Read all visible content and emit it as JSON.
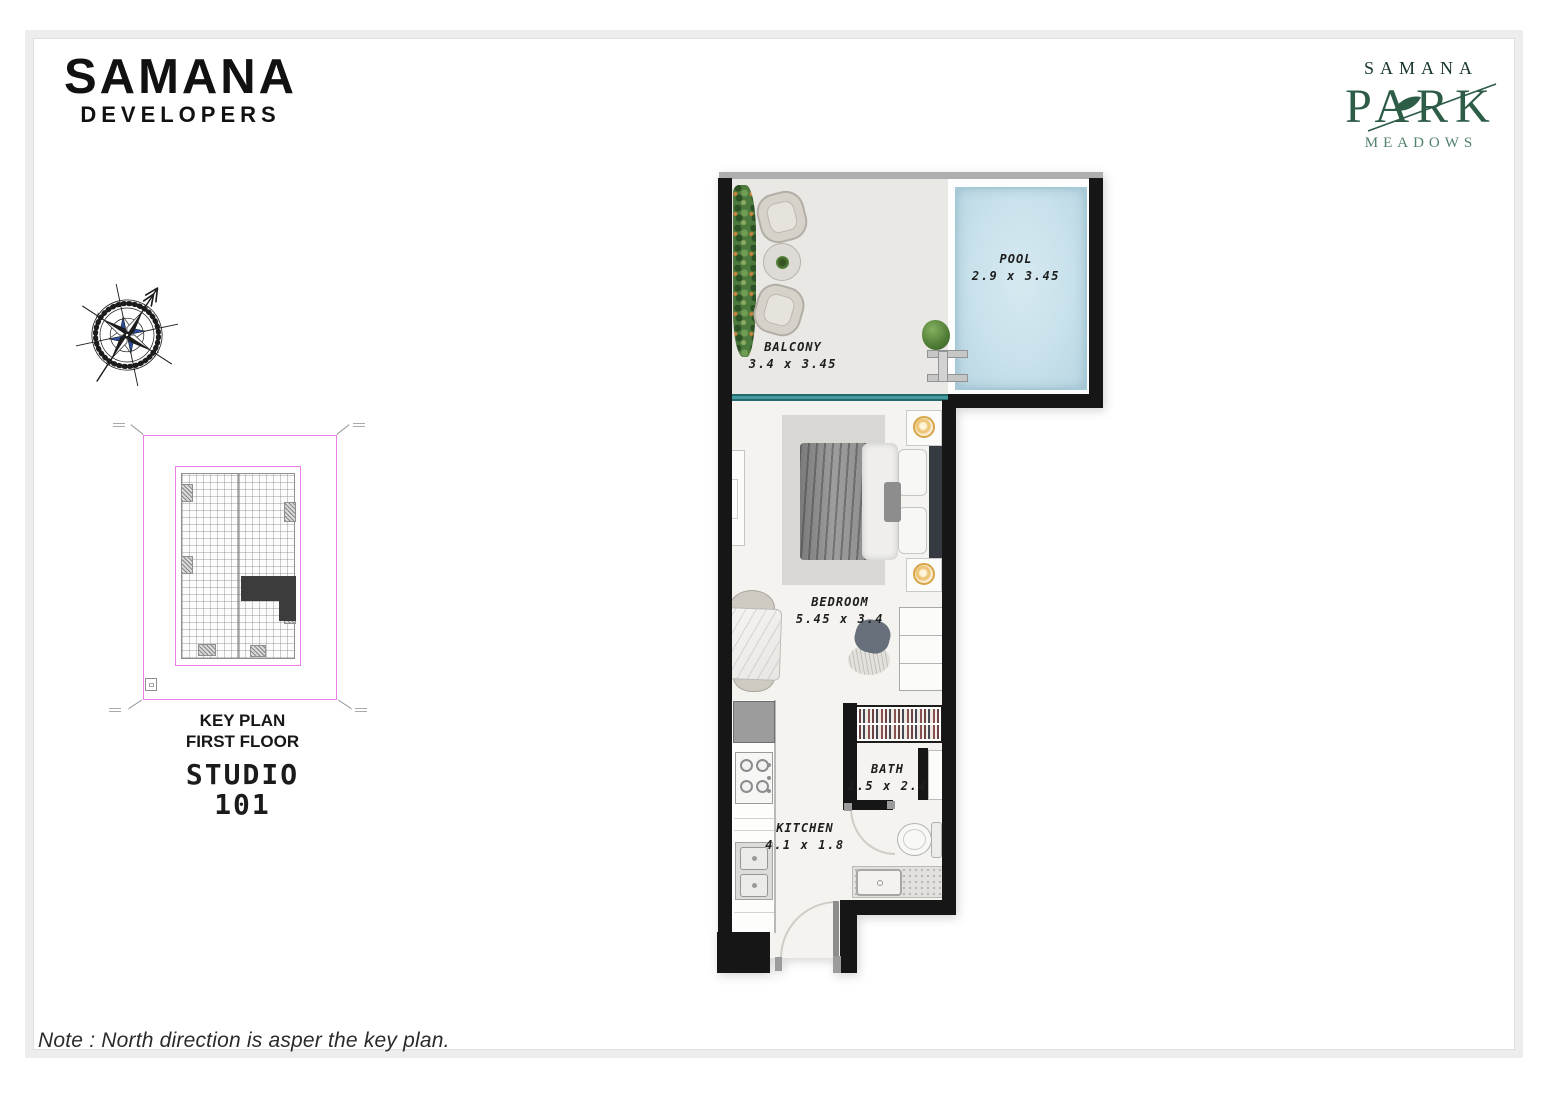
{
  "branding": {
    "developer_logo": {
      "title": "SAMANA",
      "subtitle": "DEVELOPERS"
    },
    "project_logo": {
      "brand": "SAMANA",
      "name": "PARK",
      "subtitle": "MEADOWS",
      "color": "#2d5c47"
    }
  },
  "compass": {
    "north": "N",
    "east": "E",
    "south": "S",
    "west": "W"
  },
  "key_plan": {
    "label_line1": "KEY PLAN",
    "label_line2": "FIRST FLOOR",
    "unit_type": "STUDIO",
    "unit_number": "101",
    "outline_color": "#ee7ee8",
    "highlight_color": "#3c3c3c"
  },
  "floor_plan": {
    "rooms": {
      "pool": {
        "name": "POOL",
        "dimensions": "2.9 x 3.45"
      },
      "balcony": {
        "name": "BALCONY",
        "dimensions": "3.4 x 3.45"
      },
      "bedroom": {
        "name": "BEDROOM",
        "dimensions": "5.45 x 3.4"
      },
      "bath": {
        "name": "BATH",
        "dimensions": "1.5 x 2.4"
      },
      "kitchen": {
        "name": "KITCHEN",
        "dimensions": "4.1 x 1.8"
      }
    },
    "colors": {
      "wall": "#161616",
      "pool_water": "#c8e1eb",
      "balcony_floor": "#e9e8e5",
      "room_floor": "#f4f3f0",
      "sliding_door": "#2d7d80"
    }
  },
  "footer": {
    "note": "Note : North direction is asper the key plan."
  }
}
